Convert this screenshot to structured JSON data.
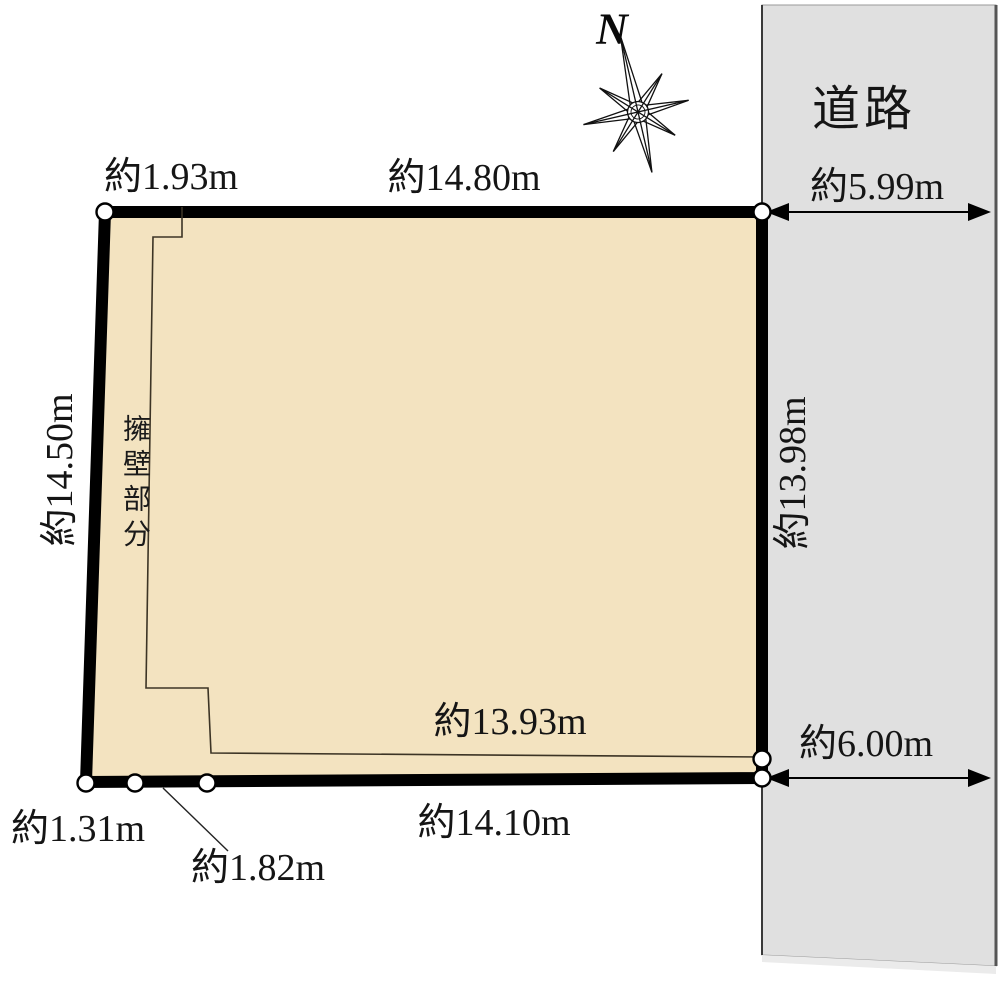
{
  "diagram_title": "land-parcel-survey-plan",
  "colors": {
    "parcel_fill": "#F3E3C0",
    "road_fill": "#E0E0E0",
    "road_fill_light": "#EBEBEB",
    "line": "#000000"
  },
  "compass": {
    "north": "N"
  },
  "road": {
    "label": "道路",
    "width_top": "約5.99m",
    "width_bottom": "約6.00m"
  },
  "parcel": {
    "annotations": {
      "retaining_wall": "擁壁部分"
    },
    "dimensions": {
      "top_left": "約1.93m",
      "top": "約14.80m",
      "left": "約14.50m",
      "right": "約13.98m",
      "inner_bottom": "約13.93m",
      "bottom": "約14.10m",
      "bottom_left_small": "約1.31m",
      "bottom_left_diagonal": "約1.82m"
    }
  }
}
